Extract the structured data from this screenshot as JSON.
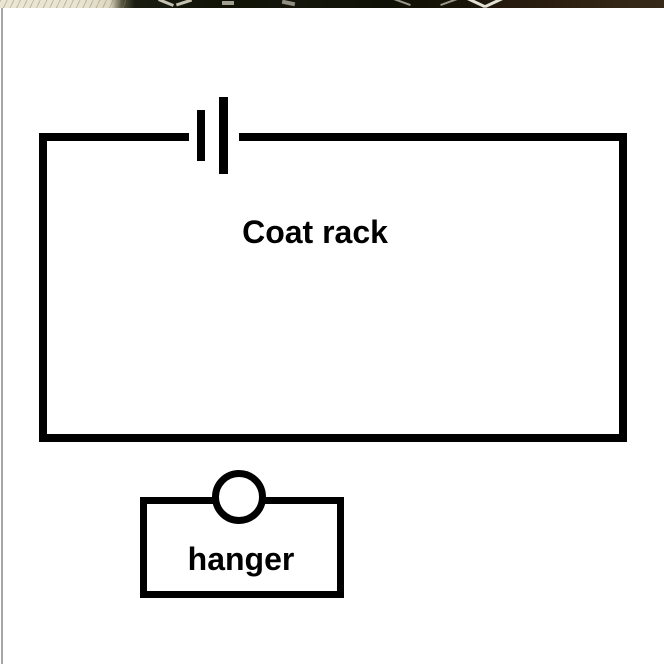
{
  "canvas": {
    "background_color": "#ffffff",
    "sheet_edge_color": "#a6a6a6"
  },
  "photo_strip": {
    "description": "thin sliver of background photo visible above white sheet",
    "left_tone": "#e8e4d2",
    "mid_tone": "#111307",
    "right_tone": "#342616"
  },
  "diagram": {
    "stroke_color": "#000000",
    "fill_color": "#ffffff",
    "coat_rack": {
      "label": "Coat rack",
      "icon": "battery-icon"
    },
    "hanger": {
      "label": "hanger",
      "icon": "hook-circle-icon"
    }
  }
}
